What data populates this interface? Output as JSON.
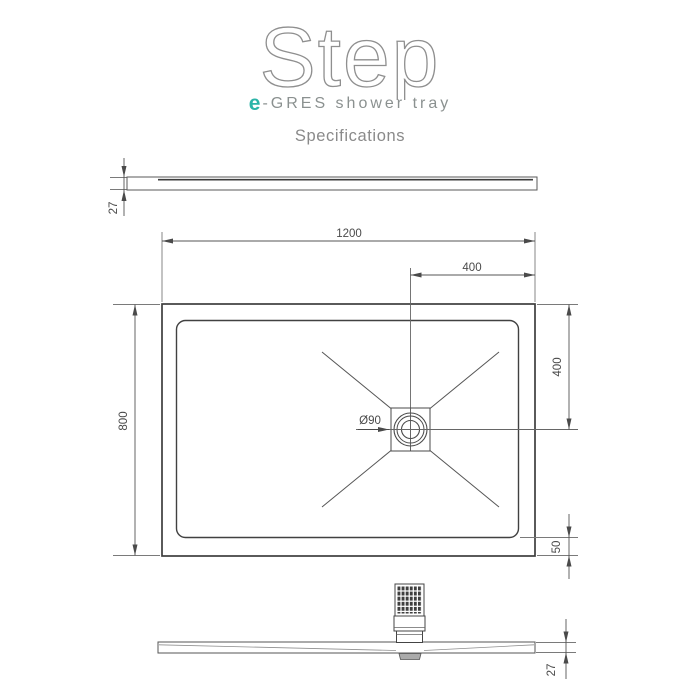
{
  "header": {
    "logo": "Step",
    "brand": {
      "accent": "e",
      "rest": "-GRES shower tray"
    },
    "section_title": "Specifications"
  },
  "dimensions": {
    "tray_width": "1200",
    "tray_depth": "800",
    "drain_offset_from_right": "400",
    "drain_offset_from_top": "400",
    "rim_to_floor": "50",
    "profile_thickness_top_view": "27",
    "profile_thickness_bottom_view": "27",
    "drain_diameter": "Ø90"
  },
  "colors": {
    "accent_teal": "#2cb4a8",
    "line_dark": "#3d3d3d",
    "line_dim": "#555555",
    "logo_gray": "#8f8f8f",
    "text_gray": "#8a8a8a"
  }
}
